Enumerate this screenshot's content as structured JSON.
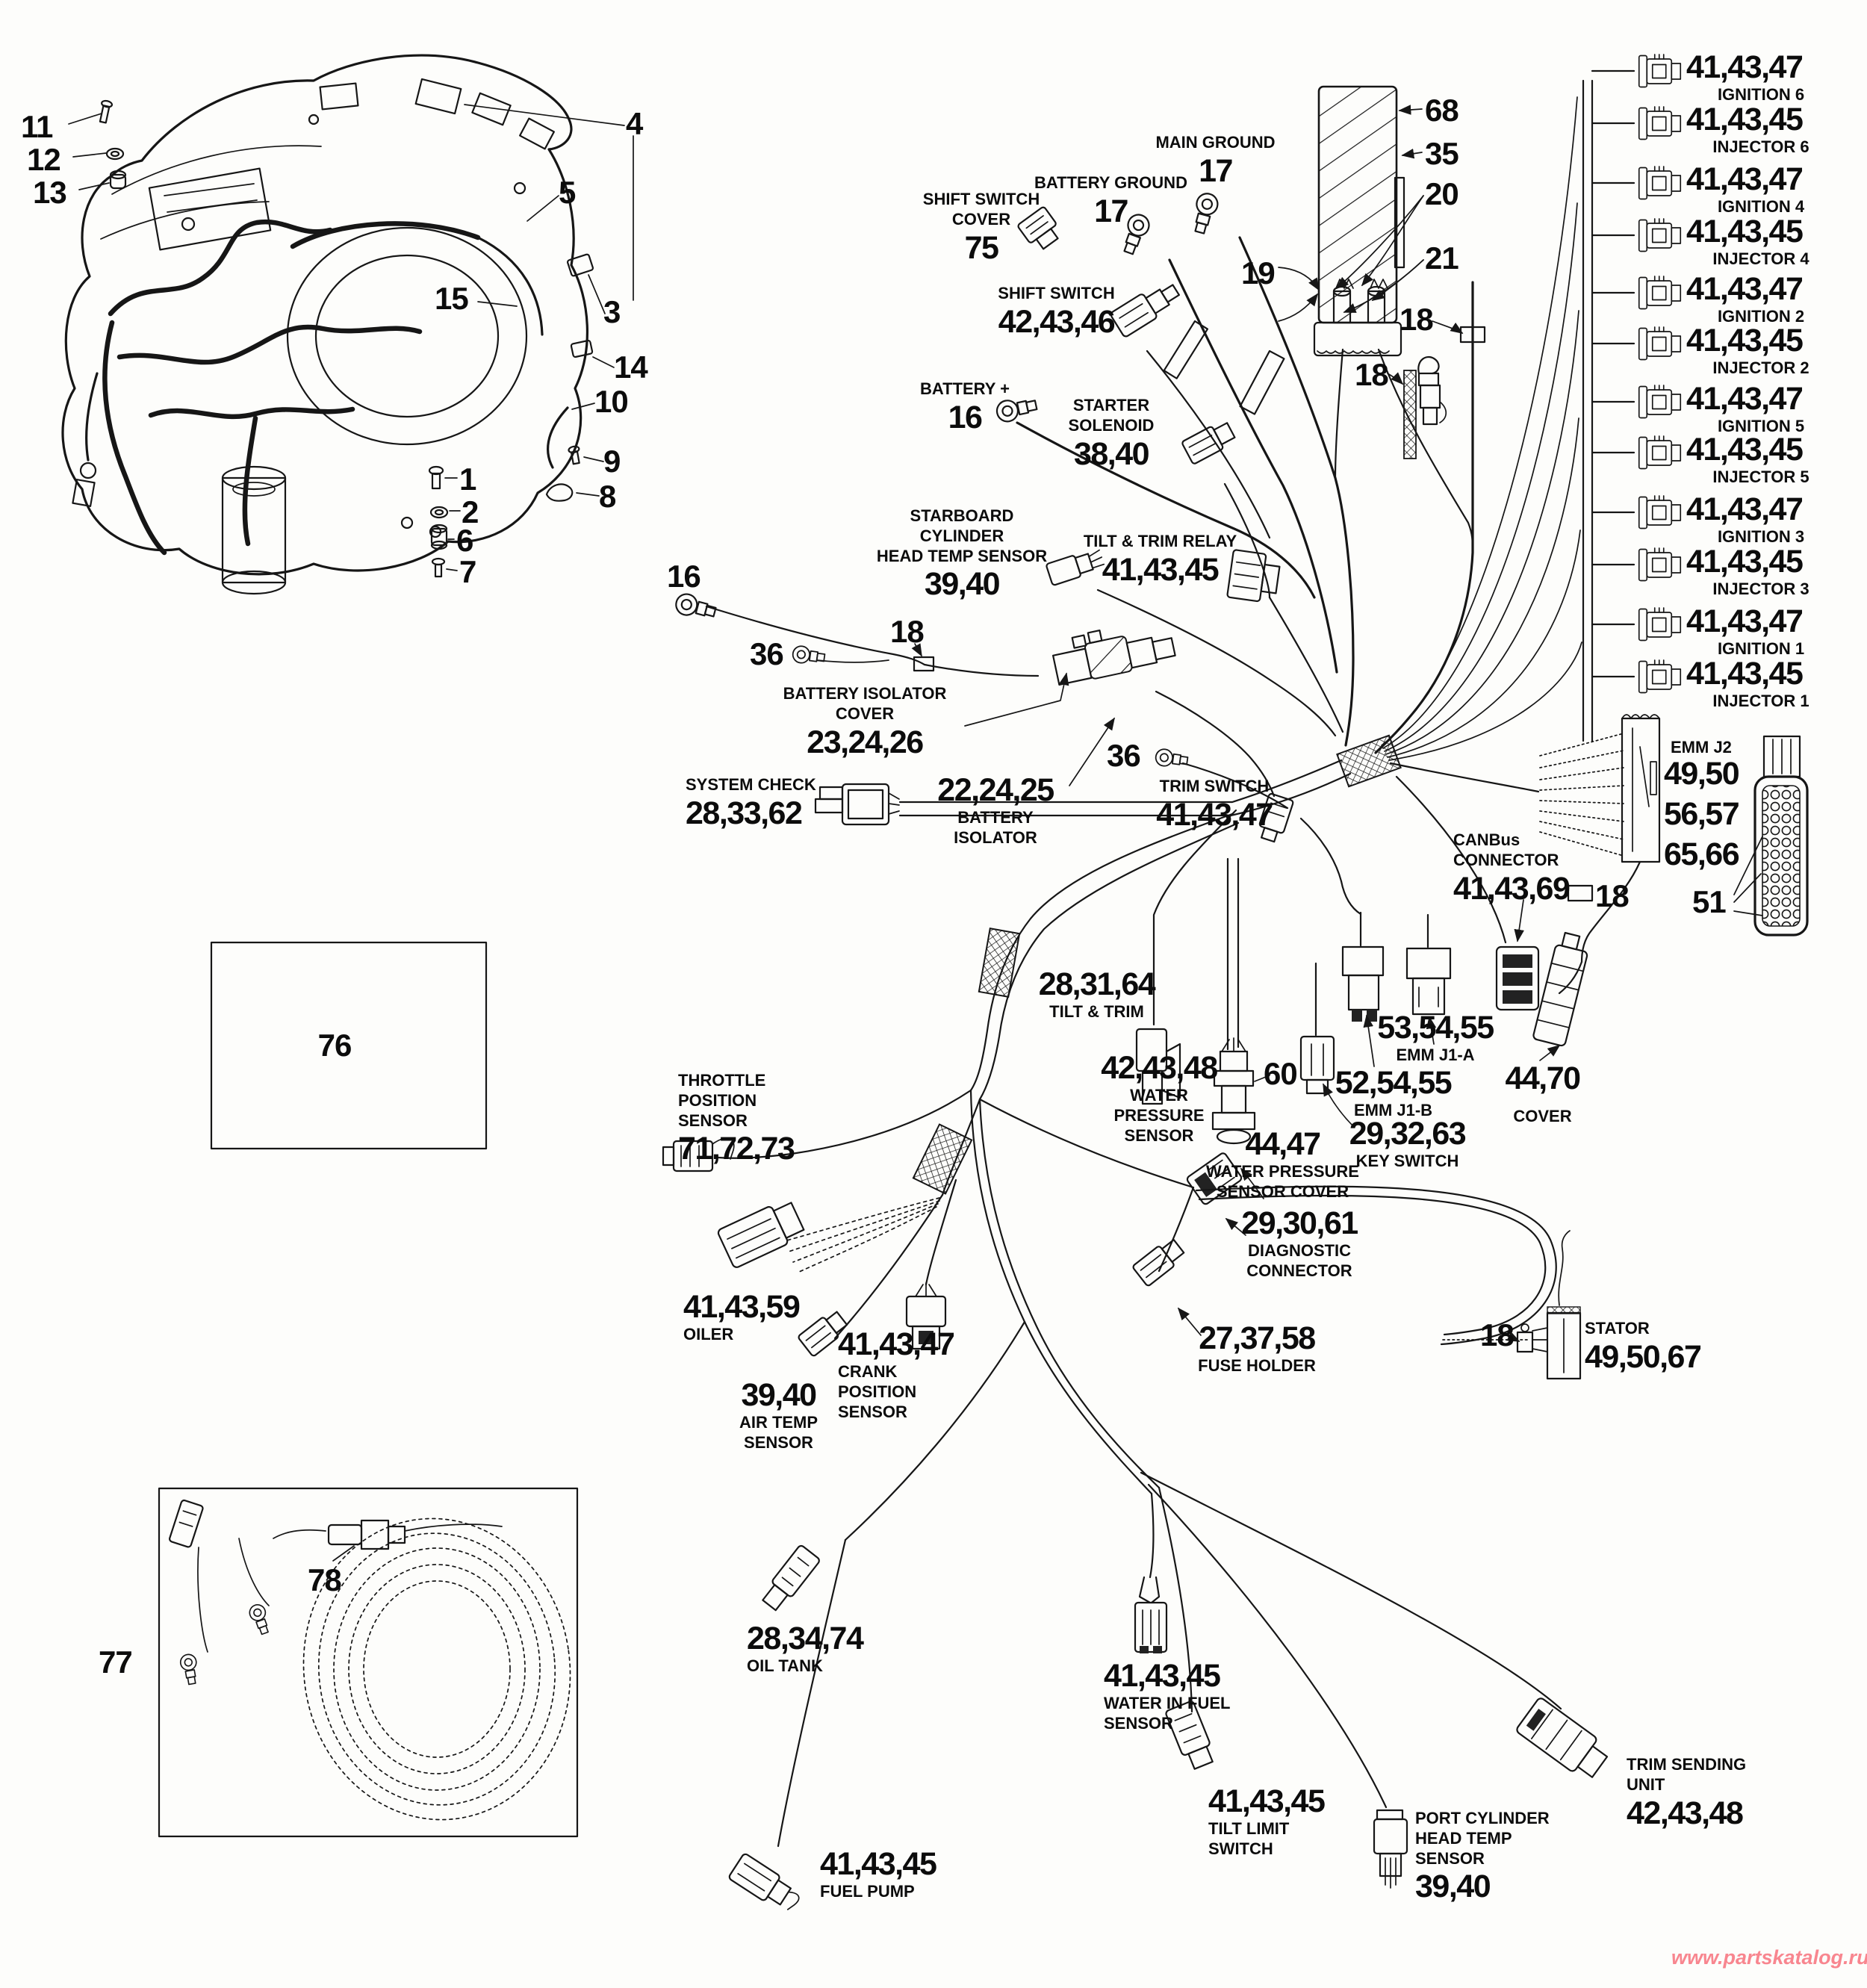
{
  "watermark": {
    "text": "www.partskatalog.ru",
    "color": "#f8868f"
  },
  "right_column": {
    "rows": [
      {
        "num": "41,43,47",
        "name": "IGNITION 6"
      },
      {
        "num": "41,43,45",
        "name": "INJECTOR 6"
      },
      {
        "num": "41,43,47",
        "name": "IGNITION 4"
      },
      {
        "num": "41,43,45",
        "name": "INJECTOR 4"
      },
      {
        "num": "41,43,47",
        "name": "IGNITION 2"
      },
      {
        "num": "41,43,45",
        "name": "INJECTOR 2"
      },
      {
        "num": "41,43,47",
        "name": "IGNITION 5"
      },
      {
        "num": "41,43,45",
        "name": "INJECTOR 5"
      },
      {
        "num": "41,43,47",
        "name": "IGNITION 3"
      },
      {
        "num": "41,43,45",
        "name": "INJECTOR 3"
      },
      {
        "num": "41,43,47",
        "name": "IGNITION 1"
      },
      {
        "num": "41,43,45",
        "name": "INJECTOR 1"
      }
    ]
  },
  "callouts": {
    "1": "1",
    "2": "2",
    "3": "3",
    "4": "4",
    "5": "5",
    "6": "6",
    "7": "7",
    "8": "8",
    "9": "9",
    "10": "10",
    "11": "11",
    "12": "12",
    "13": "13",
    "14": "14",
    "15": "15",
    "16": "16",
    "18": "18",
    "19": "19",
    "20": "20",
    "21": "21",
    "35": "35",
    "36": "36",
    "51": "51",
    "60": "60",
    "68": "68",
    "76": "76",
    "77": "77",
    "78": "78"
  },
  "parts": {
    "main_ground": {
      "name": "MAIN GROUND",
      "num": "17"
    },
    "battery_ground": {
      "name": "BATTERY GROUND",
      "num": "17"
    },
    "shift_switch_cover": {
      "name": "SHIFT SWITCH\nCOVER",
      "num": "75"
    },
    "shift_switch": {
      "name": "SHIFT SWITCH",
      "num": "42,43,46"
    },
    "battery_plus": {
      "name": "BATTERY +",
      "num": "16"
    },
    "starter_solenoid": {
      "name": "STARTER SOLENOID",
      "num": "38,40"
    },
    "starboard_head_temp": {
      "name": "STARBOARD CYLINDER\nHEAD TEMP SENSOR",
      "num": "39,40"
    },
    "tilt_trim_relay": {
      "name": "TILT & TRIM RELAY",
      "num": "41,43,45"
    },
    "battery_isolator_cover": {
      "name": "BATTERY ISOLATOR COVER",
      "num": "23,24,26"
    },
    "battery_isolator": {
      "num": "22,24,25",
      "name": "BATTERY ISOLATOR"
    },
    "trim_switch": {
      "name": "TRIM SWITCH",
      "num": "41,43,47"
    },
    "system_check": {
      "name": "SYSTEM CHECK",
      "num": "28,33,62"
    },
    "emm_j2": {
      "name": "EMM J2",
      "num1": "49,50",
      "num2": "56,57",
      "num3": "65,66"
    },
    "canbus_connector": {
      "name": "CANBus\nCONNECTOR",
      "num": "41,43,69"
    },
    "tilt_trim": {
      "num": "28,31,64",
      "name": "TILT & TRIM"
    },
    "emm_j1a": {
      "num": "53,54,55",
      "name": "EMM J1-A"
    },
    "emm_j1b": {
      "num": "52,54,55",
      "name": "EMM J1-B"
    },
    "cover": {
      "num": "44,70",
      "name": "COVER"
    },
    "water_pressure_sensor": {
      "num": "42,43,48",
      "name": "WATER\nPRESSURE\nSENSOR"
    },
    "water_pressure_sensor_cover": {
      "num": "44,47",
      "name": "WATER PRESSURE\nSENSOR COVER"
    },
    "key_switch": {
      "num": "29,32,63",
      "name": "KEY SWITCH"
    },
    "throttle_position_sensor": {
      "name": "THROTTLE POSITION\nSENSOR",
      "num": "71,72,73"
    },
    "oiler": {
      "num": "41,43,59",
      "name": "OILER"
    },
    "crank_position_sensor": {
      "num": "41,43,47",
      "name": "CRANK POSITION\nSENSOR"
    },
    "air_temp_sensor": {
      "num": "39,40",
      "name": "AIR TEMP\nSENSOR"
    },
    "diagnostic_connector": {
      "num": "29,30,61",
      "name": "DIAGNOSTIC\nCONNECTOR"
    },
    "fuse_holder": {
      "num": "27,37,58",
      "name": "FUSE HOLDER"
    },
    "stator": {
      "name": "STATOR",
      "num": "49,50,67"
    },
    "oil_tank": {
      "num": "28,34,74",
      "name": "OIL TANK"
    },
    "water_in_fuel_sensor": {
      "num": "41,43,45",
      "name": "WATER IN FUEL\nSENSOR"
    },
    "fuel_pump": {
      "num": "41,43,45",
      "name": "FUEL PUMP"
    },
    "tilt_limit_switch": {
      "num": "41,43,45",
      "name": "TILT LIMIT SWITCH"
    },
    "port_head_temp": {
      "name": "PORT CYLINDER\nHEAD TEMP SENSOR",
      "num": "39,40"
    },
    "trim_sending_unit": {
      "name": "TRIM SENDING UNIT",
      "num": "42,43,48"
    }
  }
}
